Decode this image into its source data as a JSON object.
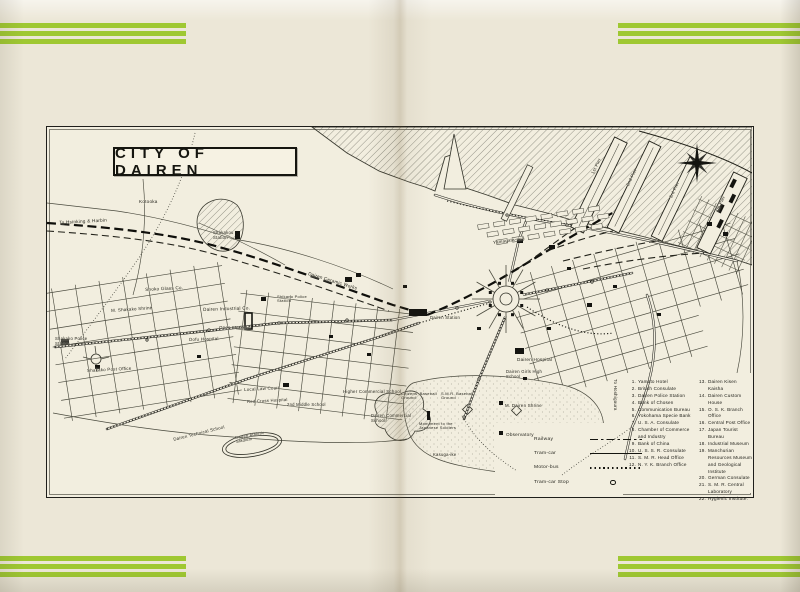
{
  "page": {
    "map_title": "CITY OF DAIREN"
  },
  "colors": {
    "stripe_green": "#9fc832",
    "paper": "#f2eedf",
    "ink": "#1c1c16"
  },
  "legend": {
    "items": [
      {
        "label": "Railway",
        "sample": "railway"
      },
      {
        "label": "Tram-car",
        "sample": "tram"
      },
      {
        "label": "Motor-bus",
        "sample": "bus"
      },
      {
        "label": "Tram-car Stop",
        "sample": "stop"
      }
    ]
  },
  "locations": {
    "column1": [
      {
        "num": "1.",
        "name": "Yamato Hotel"
      },
      {
        "num": "2.",
        "name": "British Consulate"
      },
      {
        "num": "3.",
        "name": "Dairen Police Station"
      },
      {
        "num": "4.",
        "name": "Bank of Chosen"
      },
      {
        "num": "5.",
        "name": "Communication Bureau"
      },
      {
        "num": "6.",
        "name": "Yokohama Specie Bank"
      },
      {
        "num": "7.",
        "name": "U. S. A. Consulate"
      },
      {
        "num": "8.",
        "name": "Chamber of Commerce and Industry"
      },
      {
        "num": "9.",
        "name": "Bank of China"
      },
      {
        "num": "10.",
        "name": "U. S. S. R. Consulate"
      },
      {
        "num": "11.",
        "name": "S. M. R. Head Office"
      },
      {
        "num": "12.",
        "name": "N. Y. K. Branch Office"
      }
    ],
    "column2": [
      {
        "num": "13.",
        "name": "Dairen Kisen Kaisha"
      },
      {
        "num": "14.",
        "name": "Dairen Custom House"
      },
      {
        "num": "15.",
        "name": "O. S. K. Branch Office"
      },
      {
        "num": "16.",
        "name": "Central Post Office"
      },
      {
        "num": "17.",
        "name": "Japan Tourist Bureau"
      },
      {
        "num": "18.",
        "name": "Industrial Museum"
      },
      {
        "num": "19.",
        "name": "Manchurian Resources Museum and Geological Institute"
      },
      {
        "num": "20.",
        "name": "German Consulate"
      },
      {
        "num": "21.",
        "name": "S. M. R. Central Laboratory"
      },
      {
        "num": "22.",
        "name": "Hygienic Institute."
      }
    ]
  },
  "map_labels": [
    {
      "text": "To Hsinking & Harbin",
      "x": 12,
      "y": 93,
      "rot": -3,
      "size": 4.6
    },
    {
      "text": "Kotooka",
      "x": 92,
      "y": 72,
      "size": 4.6
    },
    {
      "text": "Shakakou Station",
      "x": 166,
      "y": 104,
      "size": 4.2,
      "w": 28
    },
    {
      "text": "Shoko Glass Co.",
      "x": 98,
      "y": 160,
      "rot": -3,
      "size": 4.6
    },
    {
      "text": "M. Shakako Shrine",
      "x": 64,
      "y": 182,
      "rot": -4,
      "size": 4.4
    },
    {
      "text": "Shakako Police Station",
      "x": 8,
      "y": 210,
      "size": 4.2,
      "w": 34
    },
    {
      "text": "Shakako Post Office",
      "x": 40,
      "y": 242,
      "rot": -3,
      "size": 4.4
    },
    {
      "text": "Dairen Ceramic Works",
      "x": 262,
      "y": 144,
      "rot": 17,
      "size": 4.6
    },
    {
      "text": "Dairen Industrial Co.",
      "x": 156,
      "y": 180,
      "rot": -2,
      "size": 4.6
    },
    {
      "text": "Shikano Police Station",
      "x": 230,
      "y": 168,
      "size": 4.0,
      "w": 32
    },
    {
      "text": "Open Market",
      "x": 172,
      "y": 199,
      "size": 4.4
    },
    {
      "text": "Dofu Hospital",
      "x": 142,
      "y": 211,
      "rot": -2,
      "size": 4.4
    },
    {
      "text": "Yamagata-dori",
      "x": 446,
      "y": 114,
      "rot": -8,
      "size": 4.4
    },
    {
      "text": "Dairen Station",
      "x": 383,
      "y": 189,
      "size": 4.2
    },
    {
      "text": "Dairen Hospital",
      "x": 470,
      "y": 230,
      "size": 4.6
    },
    {
      "text": "Dairen Girls High School",
      "x": 459,
      "y": 243,
      "size": 4.2,
      "w": 40
    },
    {
      "text": "M. Dairen Shrine",
      "x": 458,
      "y": 277,
      "size": 4.4
    },
    {
      "text": "Observatory",
      "x": 459,
      "y": 305,
      "size": 4.6
    },
    {
      "text": "Local Law Court",
      "x": 197,
      "y": 261,
      "rot": -3,
      "size": 4.4
    },
    {
      "text": "Red Cross Hospital",
      "x": 200,
      "y": 273,
      "rot": -3,
      "size": 4.2
    },
    {
      "text": "2nd Middle School",
      "x": 240,
      "y": 276,
      "size": 4.2
    },
    {
      "text": "Higher Commercial School",
      "x": 296,
      "y": 263,
      "size": 4.4
    },
    {
      "text": "Dairen Commercial School",
      "x": 324,
      "y": 287,
      "size": 4.2,
      "w": 42
    },
    {
      "text": "Citizens' Baseball Ground",
      "x": 354,
      "y": 265,
      "size": 4.0,
      "w": 36
    },
    {
      "text": "S.M.R. Baseball Ground",
      "x": 394,
      "y": 265,
      "size": 4.0,
      "w": 34
    },
    {
      "text": "Monument to the Japanese Soldiers",
      "x": 372,
      "y": 295,
      "size": 4.0,
      "w": 42
    },
    {
      "text": "Kasuga-ike",
      "x": 386,
      "y": 326,
      "size": 4.2
    },
    {
      "text": "Dairen Technical School",
      "x": 126,
      "y": 311,
      "rot": -14,
      "size": 4.4
    },
    {
      "text": "Dairen Athletic Stadium",
      "x": 188,
      "y": 309,
      "rot": -10,
      "size": 4.0,
      "w": 34
    },
    {
      "text": "1st Pier",
      "x": 544,
      "y": 46,
      "rot": -64,
      "size": 4.4
    },
    {
      "text": "2nd Pier",
      "x": 579,
      "y": 58,
      "rot": -64,
      "size": 4.4
    },
    {
      "text": "3rd Pier",
      "x": 622,
      "y": 70,
      "rot": -64,
      "size": 4.4
    },
    {
      "text": "4th Pier",
      "x": 668,
      "y": 84,
      "rot": -64,
      "size": 4.4
    },
    {
      "text": "To Hoshigaura",
      "x": 570,
      "y": 252,
      "rot": 90,
      "size": 4.4
    }
  ]
}
